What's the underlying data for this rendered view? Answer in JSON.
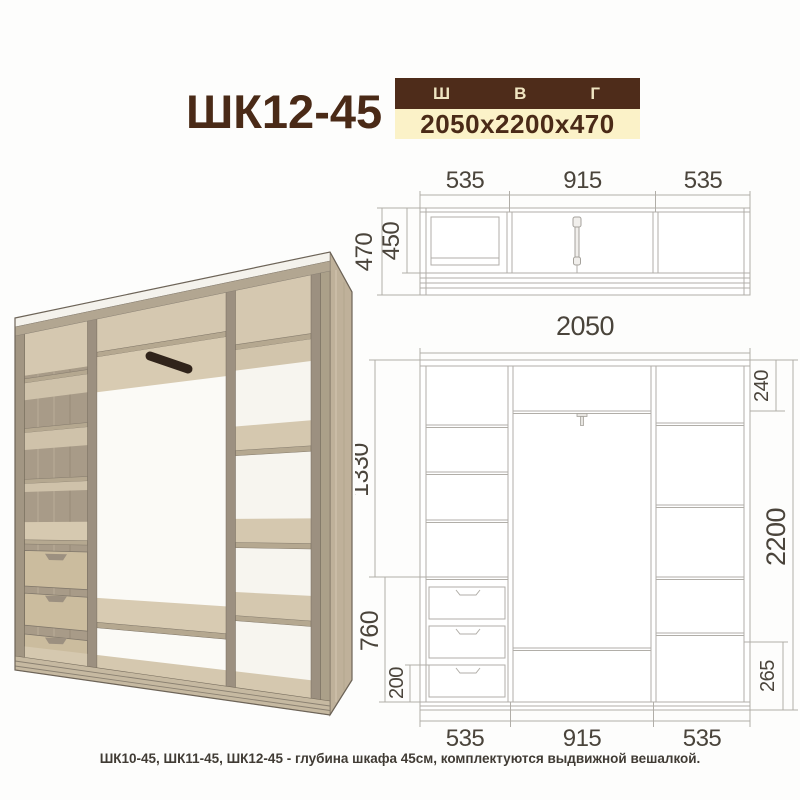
{
  "header": {
    "model": "ШК12-45",
    "legend": {
      "width": "Ш",
      "height": "В",
      "depth": "Г"
    },
    "size": "2050x2200x470"
  },
  "top_view": {
    "widths": [
      "535",
      "915",
      "535"
    ],
    "depth_total": "470",
    "depth_inner": "450"
  },
  "front_view": {
    "width_total": "2050",
    "left": {
      "upper": "1330",
      "drawers": "760",
      "plinth": "200"
    },
    "right": {
      "top": "240",
      "total": "2200",
      "bottom": "265"
    },
    "bottom_widths": [
      "535",
      "915",
      "535"
    ]
  },
  "footer": {
    "note": "ШК10-45, ШК11-45, ШК12-45 - глубина шкафа 45см, комплектуются выдвижной вешалкой."
  },
  "colors": {
    "brand_brown": "#4e2c1a",
    "title_brown": "#4a2a17",
    "cream_bar": "#fbf2c8",
    "cream_text": "#f0e6c2",
    "dim_text": "#4a443b",
    "line_gray": "#b1aea8",
    "wood_light": "#d5c8b0",
    "wood_mid": "#a89b88",
    "wood_dark": "#9c9080",
    "hanger_dark": "#30231a"
  }
}
